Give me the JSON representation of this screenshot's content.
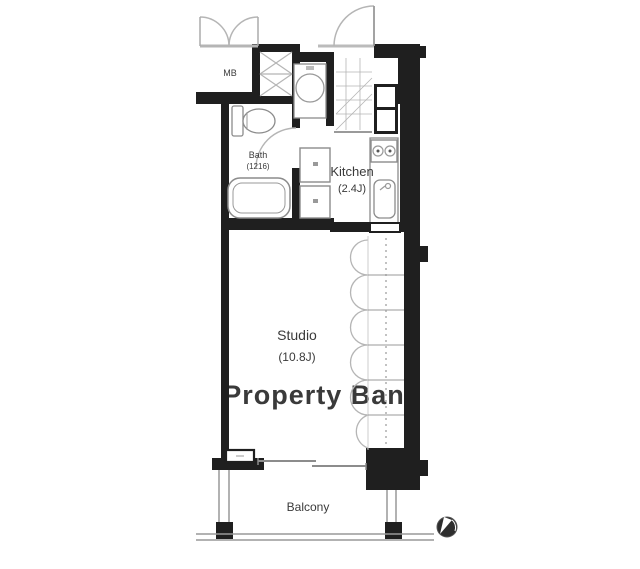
{
  "plan": {
    "mb": {
      "label": "MB"
    },
    "bath": {
      "label": "Bath",
      "size": "(1216)"
    },
    "kitchen": {
      "label": "Kitchen",
      "size": "(2.4J)"
    },
    "studio": {
      "label": "Studio",
      "size": "(10.8J)"
    },
    "balcony": {
      "label": "Balcony"
    },
    "watermark": "Property Bank",
    "icons": {
      "compass": "compass-north-icon"
    },
    "colors": {
      "wall": "#1f1f1f",
      "fixture_line": "#8c8c8c",
      "light_line": "#b5b5b5",
      "watermark": "#d9d9d9",
      "background": "#ffffff",
      "compass": "#2e2e2e"
    }
  }
}
